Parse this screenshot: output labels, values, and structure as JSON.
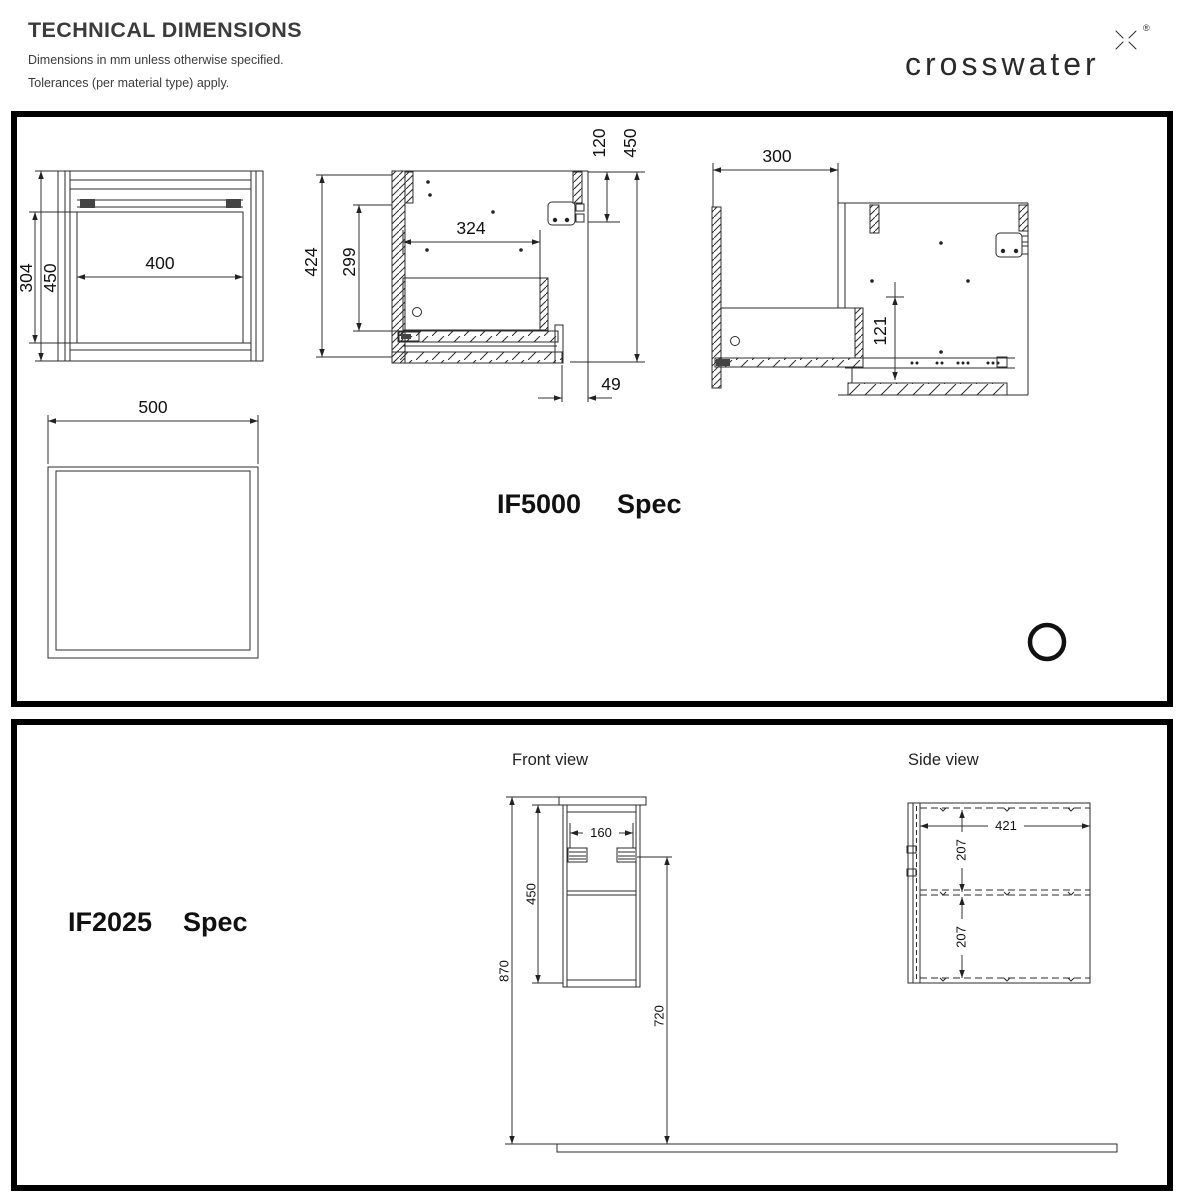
{
  "header": {
    "title": "TECHNICAL DIMENSIONS",
    "line1": "Dimensions in mm unless otherwise specified.",
    "line2": "Tolerances (per material type) apply.",
    "brand": "crosswater",
    "reg_mark": "®"
  },
  "if5000": {
    "model": "IF5000",
    "spec": "Spec",
    "front": {
      "inner_width": "400",
      "inner_height": "304",
      "outer_height": "450"
    },
    "plan": {
      "width": "500"
    },
    "section": {
      "overall_height": "424",
      "inner_height": "299",
      "inner_width": "324",
      "bracket_offset": "120",
      "overall_height_right": "450",
      "back_offset": "49"
    },
    "extended": {
      "wall_offset": "300",
      "drop": "121"
    }
  },
  "if2025": {
    "model": "IF2025",
    "spec": "Spec",
    "front_view_label": "Front view",
    "side_view_label": "Side view",
    "front": {
      "bracket_spacing": "160",
      "cabinet_height": "450",
      "overall_height": "870",
      "bracket_height": "720"
    },
    "side": {
      "depth": "421",
      "upper_section": "207",
      "lower_section": "207"
    }
  }
}
